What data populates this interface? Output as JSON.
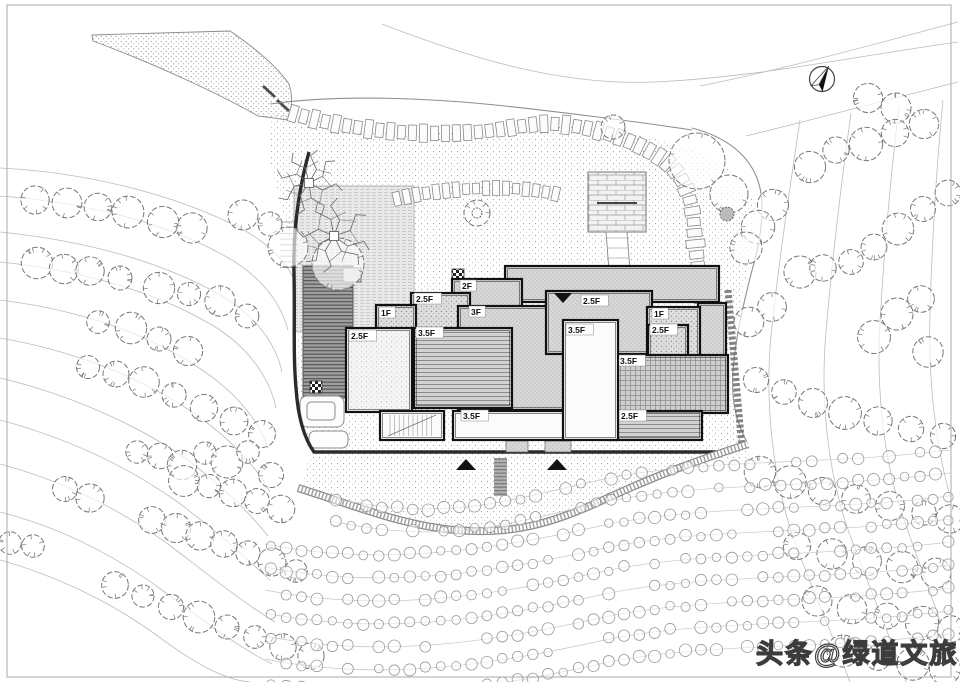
{
  "watermark": {
    "text": "头条@绿道文旅"
  },
  "plan": {
    "frame": {
      "x": 7,
      "y": 5,
      "w": 944,
      "h": 672
    },
    "north": {
      "x": 822,
      "y": 79,
      "r": 12.5,
      "rot": 28
    },
    "road": "M92,35 L230,31 C258,50 278,68 289,84 C293,96 292,108 288,120 L258,116 C220,94 150,62 93,41 Z",
    "gate": [
      "M263,86 L275,97",
      "M277,100 L289,111"
    ],
    "garden": "M272,112 C330,124 390,134 455,133 C520,131 560,122 610,130 C655,137 688,146 712,158 C740,172 756,196 758,214 C752,262 740,300 734,345 C730,392 738,420 750,446 L748,458 L312,458 C300,430 296,404 296,372 C296,330 300,300 298,272 C290,236 278,196 270,160 Z",
    "garden2": "M310,455 L745,446 C700,462 660,476 612,498 C562,521 520,537 455,531 C400,527 350,504 300,489 Z",
    "boundaries": [
      "M270,104 C340,94 430,98 505,106 C560,112 640,122 692,130",
      "M692,128 C734,139 754,162 760,188 C766,216 758,250 751,274 C743,306 735,340 733,372 C731,404 737,424 748,444"
    ],
    "contours": [
      "M382,24 C470,58 560,86 655,82 C760,77 850,57 958,42",
      "M700,86 C780,70 868,46 958,22",
      "M746,136 C820,118 886,100 958,82",
      "M0,168 C80,172 170,192 240,228 C274,246 294,270 300,296",
      "M0,196 C80,202 160,220 225,256 C258,274 280,300 288,330",
      "M0,232 C80,240 160,260 222,296 C256,316 276,344 282,372",
      "M0,262 C80,270 160,292 220,330 C252,352 270,380 276,408",
      "M0,300 C80,310 150,334 205,372 C240,396 260,424 268,448",
      "M0,338 C70,350 140,376 195,414 C235,442 258,470 270,492",
      "M0,378 C60,392 130,420 185,458 C225,488 252,516 268,536",
      "M0,420 C60,436 120,462 175,500 C218,532 248,560 270,580",
      "M0,464 C60,480 115,506 168,544 C210,576 245,604 275,622",
      "M0,512 C55,526 110,552 162,590 C205,622 240,648 272,664",
      "M0,560 C50,574 105,598 155,634 C195,664 225,680 250,682",
      "M800,120 C788,200 778,268 771,336 C765,402 772,468 790,528 C806,576 830,628 850,682",
      "M851,113 C840,192 832,262 826,332 C820,400 828,468 846,524 C862,570 888,630 906,682",
      "M899,106 C890,182 884,252 880,322 C876,392 884,456 900,508 C916,556 940,616 953,662",
      "M943,100 C936,172 932,242 930,312 C928,382 936,446 950,496"
    ],
    "wall": "M309,152 C298,192 293,232 294,274 C295,318 293,354 296,388 C298,418 304,438 314,452 L718,452",
    "strip": "M728,290 L742,448",
    "gravel": "M298,488 C350,504 400,525 455,530 C520,536 562,519 612,496 C662,473 702,459 748,444",
    "stepcol": {
      "x": 494,
      "y": 458,
      "w": 13,
      "h": 38
    },
    "terrace": {
      "x": 294,
      "y": 186,
      "w": 120,
      "h": 146
    },
    "deck": {
      "x": 303,
      "y": 266,
      "w": 50,
      "h": 132
    },
    "stairsL": {
      "x1": 280,
      "x2": 298,
      "y": 222,
      "n": 9,
      "dy": 5.7
    },
    "pools": [
      {
        "x": 300,
        "y": 396,
        "w": 44,
        "h": 31,
        "rx": 7
      },
      {
        "x": 307,
        "y": 402,
        "w": 28,
        "h": 18,
        "rx": 4
      },
      {
        "x": 309,
        "y": 431,
        "w": 39,
        "h": 17,
        "rx": 6
      }
    ],
    "checkers": [
      [
        452,
        269
      ],
      [
        310,
        381
      ]
    ],
    "platform": {
      "x": 588,
      "y": 172,
      "w": 58,
      "h": 60
    },
    "bench": "M597,203 L637,203",
    "ppath": "606,232 627,232 631,283 610,283",
    "psteps": [
      238,
      248,
      258,
      268
    ],
    "stones1": {
      "d": "M288,112 C340,128 400,135 458,133 C510,131 528,122 556,124 C600,127 640,143 664,160 C684,175 692,198 694,225 C696,255 700,282 704,305",
      "w": 16,
      "l": 8,
      "gap": 3
    },
    "stones2": {
      "d": "M392,200 C420,193 450,189 492,188 C520,188 538,190 556,194",
      "w": 13,
      "l": 7,
      "gap": 3
    },
    "porches": [
      {
        "x": 506,
        "y": 441,
        "w": 22,
        "h": 11
      },
      {
        "x": 545,
        "y": 441,
        "w": 26,
        "h": 11
      }
    ],
    "buildings": [
      {
        "id": "bg1",
        "x": 505,
        "y": 266,
        "w": 214,
        "h": 36,
        "fill": "fine",
        "label": ""
      },
      {
        "id": "bg2",
        "x": 698,
        "y": 303,
        "w": 28,
        "h": 54,
        "fill": "fine",
        "label": ""
      },
      {
        "id": "b2f",
        "x": 452,
        "y": 279,
        "w": 70,
        "h": 48,
        "fill": "fine",
        "label": "2F",
        "lx": 10,
        "ly": 9
      },
      {
        "id": "b25a",
        "x": 411,
        "y": 293,
        "w": 59,
        "h": 49,
        "fill": "dots",
        "label": "2.5F",
        "lx": 5,
        "ly": 8
      },
      {
        "id": "b1d",
        "x": 376,
        "y": 305,
        "w": 40,
        "h": 42,
        "fill": "dots",
        "label": "1F",
        "lx": 5,
        "ly": 10
      },
      {
        "id": "b3f",
        "x": 458,
        "y": 306,
        "w": 124,
        "h": 104,
        "fill": "fine",
        "label": "3F",
        "lx": 13,
        "ly": 8
      },
      {
        "id": "g25",
        "x": 546,
        "y": 291,
        "w": 106,
        "h": 63,
        "fill": "fine",
        "label": "2.5F",
        "lx": 37,
        "ly": 12
      },
      {
        "id": "i1f",
        "x": 647,
        "y": 307,
        "w": 53,
        "h": 50,
        "fill": "dots",
        "label": "1F",
        "lx": 7,
        "ly": 9
      },
      {
        "id": "j25",
        "x": 648,
        "y": 325,
        "w": 40,
        "h": 32,
        "fill": "dots",
        "label": "2.5F",
        "lx": 4,
        "ly": 7
      },
      {
        "id": "e25",
        "x": 346,
        "y": 328,
        "w": 66,
        "h": 84,
        "fill": "stippleW",
        "label": "2.5F",
        "lx": 5,
        "ly": 10
      },
      {
        "id": "f35",
        "x": 414,
        "y": 328,
        "w": 98,
        "h": 80,
        "fill": "hlines",
        "label": "3.5F",
        "lx": 4,
        "ly": 7
      },
      {
        "id": "k35",
        "x": 614,
        "y": 355,
        "w": 114,
        "h": 58,
        "fill": "grid",
        "label": "3.5F",
        "lx": 6,
        "ly": 8
      },
      {
        "id": "m25",
        "x": 608,
        "y": 411,
        "w": 94,
        "h": 29,
        "fill": "hlines",
        "label": "2.5F",
        "lx": 13,
        "ly": 7
      },
      {
        "id": "n",
        "x": 380,
        "y": 411,
        "w": 64,
        "h": 29,
        "fill": "white",
        "label": "",
        "stairs": true
      },
      {
        "id": "l35",
        "x": 453,
        "y": 411,
        "w": 112,
        "h": 29,
        "fill": "white",
        "label": "3.5F",
        "lx": 10,
        "ly": 7
      },
      {
        "id": "h35",
        "x": 563,
        "y": 320,
        "w": 55,
        "h": 120,
        "fill": "white",
        "label": "3.5F",
        "lx": 5,
        "ly": 12
      }
    ],
    "markers": {
      "down": [
        [
          563,
          294
        ]
      ],
      "up": [
        [
          466,
          460
        ],
        [
          557,
          460
        ]
      ]
    },
    "treesGarden": [
      {
        "x": 697,
        "y": 161,
        "r": 28
      },
      {
        "x": 729,
        "y": 194,
        "r": 19
      },
      {
        "x": 613,
        "y": 127,
        "r": 12
      },
      {
        "x": 477,
        "y": 213,
        "r": 13
      },
      {
        "x": 288,
        "y": 247,
        "r": 20
      },
      {
        "x": 338,
        "y": 264,
        "r": 26
      },
      {
        "x": 243,
        "y": 215,
        "r": 15
      },
      {
        "x": 270,
        "y": 224,
        "r": 12
      }
    ],
    "bush": {
      "x": 727,
      "y": 214,
      "r": 7
    },
    "branchTrees": [
      {
        "x": 309,
        "y": 183,
        "r": 34
      },
      {
        "x": 334,
        "y": 236,
        "r": 38
      }
    ],
    "treesLeft": [
      [
        35,
        200
      ],
      [
        67,
        203
      ],
      [
        98,
        207
      ],
      [
        128,
        212
      ],
      [
        163,
        222
      ],
      [
        192,
        228
      ],
      [
        37,
        263
      ],
      [
        64,
        269
      ],
      [
        90,
        271
      ],
      [
        120,
        278
      ],
      [
        159,
        288
      ],
      [
        189,
        294
      ],
      [
        220,
        301
      ],
      [
        247,
        316
      ],
      [
        98,
        322
      ],
      [
        131,
        328
      ],
      [
        159,
        339
      ],
      [
        188,
        351
      ],
      [
        88,
        367
      ],
      [
        116,
        374
      ],
      [
        144,
        382
      ],
      [
        174,
        395
      ],
      [
        204,
        408
      ],
      [
        234,
        421
      ],
      [
        262,
        434
      ],
      [
        10,
        543
      ],
      [
        33,
        546
      ],
      [
        65,
        489
      ],
      [
        90,
        498
      ],
      [
        137,
        452
      ],
      [
        160,
        456
      ],
      [
        182,
        465
      ],
      [
        205,
        453
      ],
      [
        227,
        462
      ],
      [
        248,
        452
      ],
      [
        271,
        475
      ],
      [
        184,
        481
      ],
      [
        209,
        486
      ],
      [
        233,
        493
      ],
      [
        257,
        501
      ],
      [
        281,
        509
      ],
      [
        152,
        520
      ],
      [
        176,
        528
      ],
      [
        200,
        536
      ],
      [
        224,
        544
      ],
      [
        248,
        553
      ],
      [
        272,
        562
      ],
      [
        296,
        571
      ],
      [
        115,
        585
      ],
      [
        143,
        596
      ],
      [
        171,
        607
      ],
      [
        199,
        617
      ],
      [
        227,
        627
      ],
      [
        255,
        637
      ],
      [
        283,
        647
      ],
      [
        311,
        656
      ]
    ],
    "treesRight": [
      [
        868,
        98
      ],
      [
        896,
        108
      ],
      [
        810,
        167
      ],
      [
        836,
        150
      ],
      [
        866,
        144
      ],
      [
        895,
        133
      ],
      [
        924,
        124
      ],
      [
        773,
        205
      ],
      [
        758,
        227
      ],
      [
        746,
        248
      ],
      [
        800,
        272
      ],
      [
        823,
        268
      ],
      [
        851,
        262
      ],
      [
        874,
        247
      ],
      [
        898,
        229
      ],
      [
        923,
        209
      ],
      [
        948,
        193
      ],
      [
        772,
        307
      ],
      [
        749,
        322
      ],
      [
        921,
        299
      ],
      [
        897,
        314
      ],
      [
        874,
        337
      ],
      [
        928,
        352
      ],
      [
        756,
        380
      ],
      [
        784,
        392
      ],
      [
        813,
        403
      ],
      [
        845,
        413
      ],
      [
        878,
        421
      ],
      [
        911,
        429
      ],
      [
        943,
        436
      ],
      [
        760,
        472
      ],
      [
        790,
        482
      ],
      [
        822,
        491
      ],
      [
        856,
        499
      ],
      [
        890,
        506
      ],
      [
        924,
        513
      ],
      [
        950,
        519
      ],
      [
        797,
        546
      ],
      [
        832,
        554
      ],
      [
        867,
        561
      ],
      [
        902,
        567
      ],
      [
        936,
        573
      ],
      [
        817,
        601
      ],
      [
        852,
        609
      ],
      [
        887,
        616
      ],
      [
        922,
        623
      ],
      [
        951,
        629
      ],
      [
        843,
        651
      ],
      [
        878,
        658
      ],
      [
        913,
        664
      ],
      [
        945,
        669
      ]
    ],
    "shrubs": {
      "rows": 9,
      "y0": 492,
      "dy": 23,
      "xs": [
        330,
        330,
        265,
        265,
        265,
        265,
        265,
        265,
        265
      ],
      "xe": 950,
      "r": 5.2,
      "step": 15.5
    }
  }
}
